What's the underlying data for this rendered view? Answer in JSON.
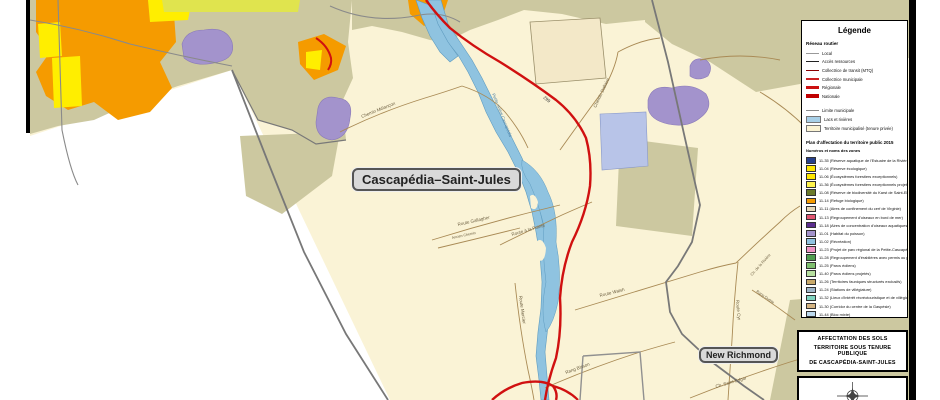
{
  "map": {
    "region_labels": {
      "municipality": "Cascapédia–Saint-Jules",
      "neighbor": "New Richmond"
    },
    "road_labels": [
      {
        "text": "Chemin Mélançon"
      },
      {
        "text": "Chemin Dallaire"
      },
      {
        "text": "Route Gallagher"
      },
      {
        "text": "Ancien Chemin"
      },
      {
        "text": "Route à la Pointe"
      },
      {
        "text": "Route Mercier"
      },
      {
        "text": "Route Walsh"
      },
      {
        "text": "Rang Bisson"
      },
      {
        "text": "Route Cyr"
      },
      {
        "text": "Ch. de la Rivière"
      },
      {
        "text": "Rang Duthie"
      },
      {
        "text": "Ch. Saint-Edgar"
      },
      {
        "text": "299"
      },
      {
        "text": "Petite rivière Cascapédia"
      }
    ]
  },
  "legend": {
    "title": "Légende",
    "road_section_title": "Réseau routier",
    "road_items": [
      {
        "label": "Local"
      },
      {
        "label": "Accès ressources"
      },
      {
        "label": "Collectrice de transit (MTQ)"
      },
      {
        "label": "Collectrice municipale"
      },
      {
        "label": "Régionale"
      },
      {
        "label": "Nationale"
      }
    ],
    "area_items": [
      {
        "label": "Limite municipale"
      },
      {
        "label": "Lacs et rivières"
      },
      {
        "label": "Territoire municipalisé (tenure privée)"
      }
    ],
    "plan_title": "Plan d'affectation du territoire public 2015",
    "plan_subtitle": "Numéros et noms des zones",
    "zones": [
      {
        "label": "11-35 (Réserve aquatique de l'Estuaire de la Rivière Bonaventure)",
        "color": "#27408b"
      },
      {
        "label": "11-04 (Réserve écologique)",
        "color": "#ffe800"
      },
      {
        "label": "11-06 (Écosystèmes forestiers exceptionnels)",
        "color": "#ffe800"
      },
      {
        "label": "11-36 (Écosystèmes forestiers exceptionnels projetés)",
        "color": "#fff34d"
      },
      {
        "label": "11-08 (Réserve de biodiversité du Karst de Saint-Elzéar)",
        "color": "#6b7a2a"
      },
      {
        "label": "11-14 (Refuge biologique)",
        "color": "#f59b00"
      },
      {
        "label": "11-11 (Aires de confinement du cerf de Virginie)",
        "color": "#e6d9b8"
      },
      {
        "label": "11-13 (Regroupement d'oiseaux en bord de mer)",
        "color": "#e05570"
      },
      {
        "label": "11-18 (Aires de concentration d'oiseaux aquatiques projetées)",
        "color": "#5b2d8f"
      },
      {
        "label": "11-01 (Habitat du poisson)",
        "color": "#a393cc"
      },
      {
        "label": "11-02 (Récréation)",
        "color": "#8fc3e0"
      },
      {
        "label": "11-23 (Projet de parc régional de la Petite-Cascapédia)",
        "color": "#ef93c4"
      },
      {
        "label": "11-28 (Regroupement d'érablières avec permis ou potentiel acéricole)",
        "color": "#4f9d4f"
      },
      {
        "label": "11-25 (Parcs éoliens)",
        "color": "#7fbf6f"
      },
      {
        "label": "11-40 (Parcs éoliens projetés)",
        "color": "#b7e0a0"
      },
      {
        "label": "11-26 (Territoires fauniques structurés exclusifs)",
        "color": "#c9a96a"
      },
      {
        "label": "11-24 (Stations de villégiature)",
        "color": "#9fb6c9"
      },
      {
        "label": "11-32 (Lieux d'intérêt récréotouristique et de villégiature)",
        "color": "#7fd4c0"
      },
      {
        "label": "11-30 (Corridor du centre de la Gaspésie)",
        "color": "#d4b483"
      },
      {
        "label": "11-44 (Bloc mixte)",
        "color": "#bcd9ee"
      }
    ]
  },
  "title_block": {
    "line1": "AFFECTATION DES SOLS",
    "line2": "TERRITOIRE SOUS TENURE PUBLIQUE",
    "line3": "DE CASCAPÉDIA-SAINT-JULES"
  },
  "colors": {
    "public_land": "#ccc8a0",
    "municipal_land": "#faf3d6",
    "water": "#8fc3e0",
    "main_road": "#d01010",
    "boundary": "#787878"
  }
}
